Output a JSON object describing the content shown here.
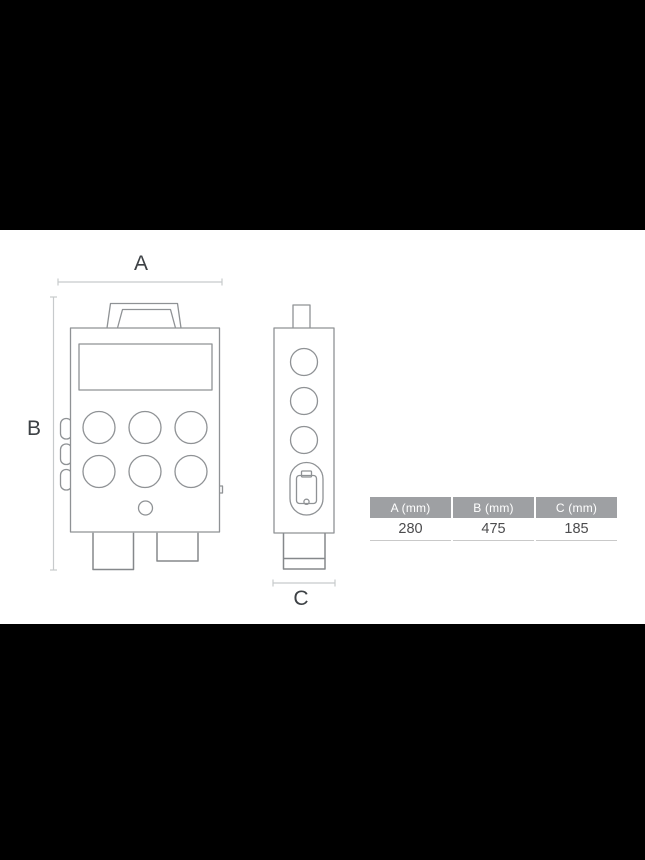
{
  "dims": {
    "a": {
      "label": "A"
    },
    "b": {
      "label": "B"
    },
    "c": {
      "label": "C"
    }
  },
  "table": {
    "headers": [
      "A (mm)",
      "B (mm)",
      "C (mm)"
    ],
    "row": [
      "280",
      "475",
      "185"
    ]
  },
  "colors": {
    "canvas_bg": "#000000",
    "content_bg": "#ffffff",
    "line_color": "#8f9295",
    "foot_color": "#85888b",
    "dim_color": "#c7cacc",
    "label_color": "#3d4145",
    "header_bg": "#9ea0a3",
    "header_text": "#ffffff",
    "value_color": "#4c4c4e",
    "table_border": "#c9c9c9"
  }
}
